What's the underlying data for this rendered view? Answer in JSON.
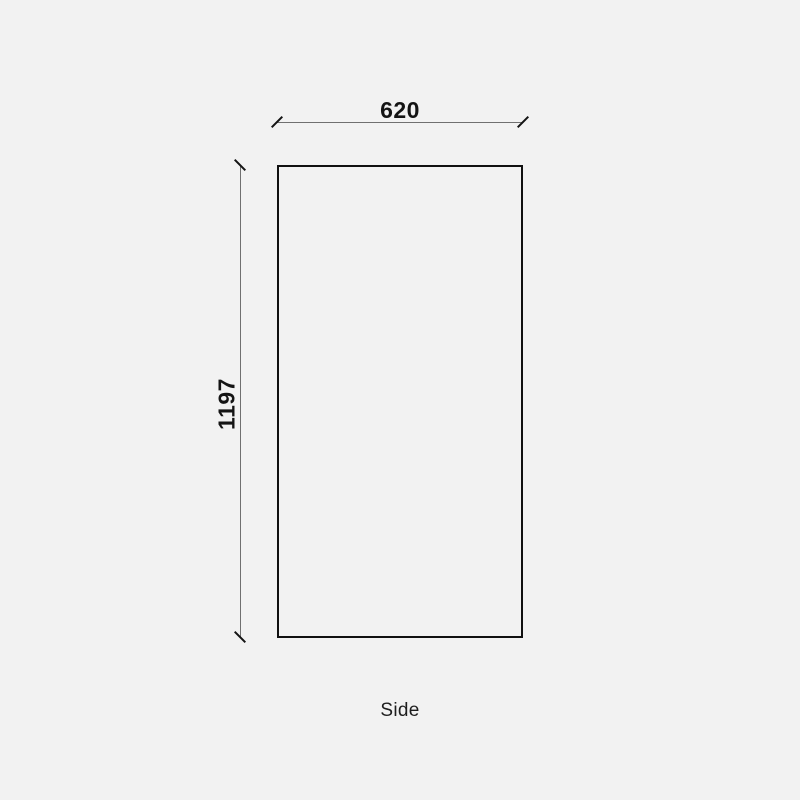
{
  "drawing": {
    "view_label": "Side",
    "dimensions": {
      "width": {
        "value": "620",
        "orientation": "horizontal"
      },
      "height": {
        "value": "1197",
        "orientation": "vertical"
      }
    },
    "style": {
      "tick_style": "architectural-slash",
      "colors": {
        "background": "#f2f2f2",
        "outline": "#111111",
        "dimension_line": "#707070",
        "tick": "#141414",
        "text": "#141414"
      }
    }
  }
}
